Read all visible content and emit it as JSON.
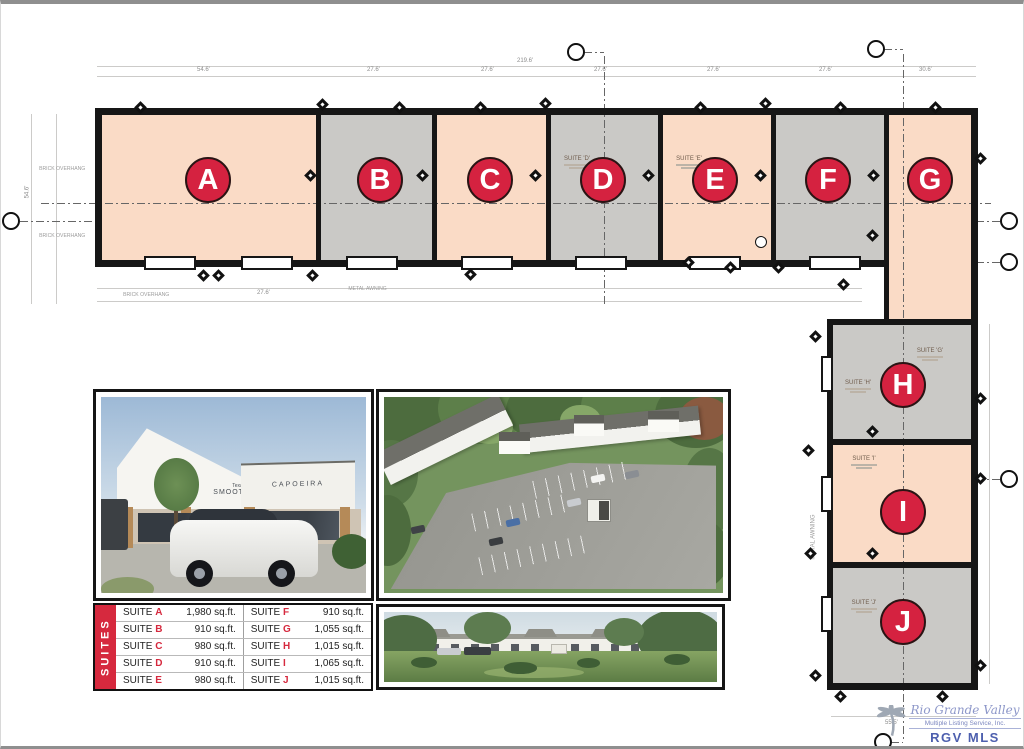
{
  "plan": {
    "suite_areas": [
      {
        "id": "A",
        "tone": "pink",
        "x": 101,
        "y": 111,
        "w": 214,
        "h": 145
      },
      {
        "id": "B",
        "tone": "gray",
        "x": 320,
        "y": 111,
        "w": 111,
        "h": 145
      },
      {
        "id": "C",
        "tone": "pink",
        "x": 436,
        "y": 111,
        "w": 109,
        "h": 145
      },
      {
        "id": "D",
        "tone": "gray",
        "x": 550,
        "y": 111,
        "w": 107,
        "h": 145
      },
      {
        "id": "E",
        "tone": "pink",
        "x": 662,
        "y": 111,
        "w": 108,
        "h": 145
      },
      {
        "id": "F",
        "tone": "gray",
        "x": 775,
        "y": 111,
        "w": 108,
        "h": 145
      },
      {
        "id": "G",
        "tone": "pink",
        "x": 888,
        "y": 111,
        "w": 82,
        "h": 204
      },
      {
        "id": "H",
        "tone": "gray",
        "x": 832,
        "y": 321,
        "w": 138,
        "h": 114
      },
      {
        "id": "I",
        "tone": "pink",
        "x": 832,
        "y": 441,
        "w": 138,
        "h": 117
      },
      {
        "id": "J",
        "tone": "gray",
        "x": 832,
        "y": 564,
        "w": 138,
        "h": 115
      }
    ],
    "badges": [
      {
        "id": "A",
        "x": 207,
        "y": 176
      },
      {
        "id": "B",
        "x": 379,
        "y": 176
      },
      {
        "id": "C",
        "x": 489,
        "y": 176
      },
      {
        "id": "D",
        "x": 602,
        "y": 176
      },
      {
        "id": "E",
        "x": 714,
        "y": 176
      },
      {
        "id": "F",
        "x": 827,
        "y": 176
      },
      {
        "id": "G",
        "x": 929,
        "y": 176
      },
      {
        "id": "H",
        "x": 902,
        "y": 381
      },
      {
        "id": "I",
        "x": 902,
        "y": 508
      },
      {
        "id": "J",
        "x": 902,
        "y": 618
      }
    ],
    "suite_labels": [
      {
        "t": "SUITE 'D'",
        "x": 553,
        "y": 152
      },
      {
        "t": "SUITE 'E'",
        "x": 665,
        "y": 152
      },
      {
        "t": "SUITE 'G'",
        "x": 906,
        "y": 344
      },
      {
        "t": "SUITE 'H'",
        "x": 834,
        "y": 376
      },
      {
        "t": "SUITE 'I'",
        "x": 840,
        "y": 452
      },
      {
        "t": "SUITE 'J'",
        "x": 840,
        "y": 596
      }
    ],
    "walls": [
      [
        94,
        104,
        883,
        7
      ],
      [
        94,
        104,
        7,
        159
      ],
      [
        94,
        256,
        794,
        7
      ],
      [
        315,
        111,
        5,
        150
      ],
      [
        431,
        111,
        5,
        150
      ],
      [
        545,
        111,
        5,
        150
      ],
      [
        657,
        111,
        5,
        150
      ],
      [
        770,
        111,
        5,
        150
      ],
      [
        883,
        111,
        5,
        150
      ],
      [
        970,
        104,
        7,
        582
      ],
      [
        883,
        256,
        5,
        59
      ],
      [
        826,
        315,
        149,
        6
      ],
      [
        826,
        315,
        6,
        371
      ],
      [
        832,
        435,
        138,
        6
      ],
      [
        832,
        558,
        138,
        6
      ],
      [
        826,
        679,
        151,
        7
      ]
    ],
    "recesses": [
      [
        143,
        252,
        52,
        14
      ],
      [
        240,
        252,
        52,
        14
      ],
      [
        345,
        252,
        52,
        14
      ],
      [
        460,
        252,
        52,
        14
      ],
      [
        574,
        252,
        52,
        14
      ],
      [
        688,
        252,
        52,
        14
      ],
      [
        808,
        252,
        52,
        14
      ],
      [
        820,
        352,
        12,
        36
      ],
      [
        820,
        472,
        12,
        36
      ],
      [
        820,
        592,
        12,
        36
      ]
    ],
    "diamonds": [
      [
        140,
        104
      ],
      [
        322,
        101
      ],
      [
        399,
        104
      ],
      [
        480,
        104
      ],
      [
        545,
        100
      ],
      [
        700,
        104
      ],
      [
        765,
        100
      ],
      [
        840,
        104
      ],
      [
        935,
        104
      ],
      [
        310,
        172
      ],
      [
        422,
        172
      ],
      [
        535,
        172
      ],
      [
        648,
        172
      ],
      [
        760,
        172
      ],
      [
        873,
        172
      ],
      [
        980,
        155
      ],
      [
        872,
        232
      ],
      [
        203,
        272
      ],
      [
        218,
        272
      ],
      [
        312,
        272
      ],
      [
        470,
        271
      ],
      [
        688,
        259
      ],
      [
        730,
        264
      ],
      [
        778,
        264
      ],
      [
        843,
        281
      ],
      [
        815,
        333
      ],
      [
        808,
        447
      ],
      [
        872,
        428
      ],
      [
        980,
        395
      ],
      [
        810,
        550
      ],
      [
        872,
        550
      ],
      [
        980,
        475
      ],
      [
        815,
        672
      ],
      [
        980,
        662
      ],
      [
        840,
        693
      ],
      [
        942,
        693
      ]
    ],
    "bubbles": [
      [
        575,
        48,
        0
      ],
      [
        875,
        45,
        0
      ],
      [
        10,
        217,
        0
      ],
      [
        1008,
        217,
        0
      ],
      [
        1008,
        258,
        0
      ],
      [
        1008,
        475,
        0
      ],
      [
        882,
        738,
        0
      ],
      [
        760,
        238,
        1
      ]
    ],
    "dashdots": [
      [
        "h",
        40,
        199,
        950
      ],
      [
        "v",
        603,
        52,
        250
      ],
      [
        "v",
        902,
        50,
        688
      ],
      [
        "h",
        975,
        217,
        28
      ],
      [
        "h",
        975,
        258,
        28
      ],
      [
        "h",
        975,
        475,
        28
      ],
      [
        "h",
        583,
        48,
        20
      ],
      [
        "h",
        883,
        45,
        19
      ],
      [
        "h",
        19,
        217,
        75
      ],
      [
        "h",
        890,
        738,
        12
      ]
    ],
    "dimlines": [
      [
        "h",
        96,
        62,
        879
      ],
      [
        "h",
        96,
        72,
        879
      ],
      [
        "v",
        30,
        110,
        190
      ],
      [
        "v",
        55,
        110,
        190
      ],
      [
        "v",
        988,
        320,
        360
      ],
      [
        "h",
        830,
        712,
        145
      ],
      [
        "h",
        96,
        284,
        765
      ],
      [
        "h",
        96,
        297,
        765
      ]
    ],
    "dim_labels": [
      {
        "t": "219.6'",
        "x": 516,
        "y": 54
      },
      {
        "t": "54.6'",
        "x": 196,
        "y": 63
      },
      {
        "t": "27.6'",
        "x": 366,
        "y": 63
      },
      {
        "t": "27.6'",
        "x": 480,
        "y": 63
      },
      {
        "t": "27.6'",
        "x": 593,
        "y": 63
      },
      {
        "t": "27.6'",
        "x": 706,
        "y": 63
      },
      {
        "t": "27.6'",
        "x": 818,
        "y": 63
      },
      {
        "t": "30.6'",
        "x": 918,
        "y": 63
      },
      {
        "t": "54.6'",
        "x": 20,
        "y": 185,
        "rot": 1
      },
      {
        "t": "55.5'",
        "x": 884,
        "y": 716
      },
      {
        "t": "27.6'",
        "x": 256,
        "y": 286
      }
    ],
    "notes": [
      {
        "t": "BRICK OVERHANG",
        "x": 34,
        "y": 162
      },
      {
        "t": "BRICK OVERHANG",
        "x": 34,
        "y": 229
      },
      {
        "t": "BRICK OVERHANG",
        "x": 118,
        "y": 288
      },
      {
        "t": "METAL AWNING",
        "x": 344,
        "y": 282
      },
      {
        "t": "METAL AWNING",
        "x": 790,
        "y": 530,
        "rot": 1
      }
    ]
  },
  "photos": {
    "front": {
      "sign1_top": "Texas",
      "sign1": "SMOOTHIES",
      "sign2": "CAPOEIRA"
    }
  },
  "table": {
    "side_label": "SUITES",
    "suite_word": "SUITE",
    "left": [
      {
        "letter": "A",
        "area": "1,980 sq.ft."
      },
      {
        "letter": "B",
        "area": "910 sq.ft."
      },
      {
        "letter": "C",
        "area": "980 sq.ft."
      },
      {
        "letter": "D",
        "area": "910 sq.ft."
      },
      {
        "letter": "E",
        "area": "980 sq.ft."
      }
    ],
    "right": [
      {
        "letter": "F",
        "area": "910 sq.ft."
      },
      {
        "letter": "G",
        "area": "1,055 sq.ft."
      },
      {
        "letter": "H",
        "area": "1,015 sq.ft."
      },
      {
        "letter": "I",
        "area": "1,065 sq.ft."
      },
      {
        "letter": "J",
        "area": "1,015 sq.ft."
      }
    ]
  },
  "logo": {
    "name": "Rio Grande Valley",
    "sub": "Multiple Listing Service, Inc.",
    "abbr": "RGV MLS"
  }
}
